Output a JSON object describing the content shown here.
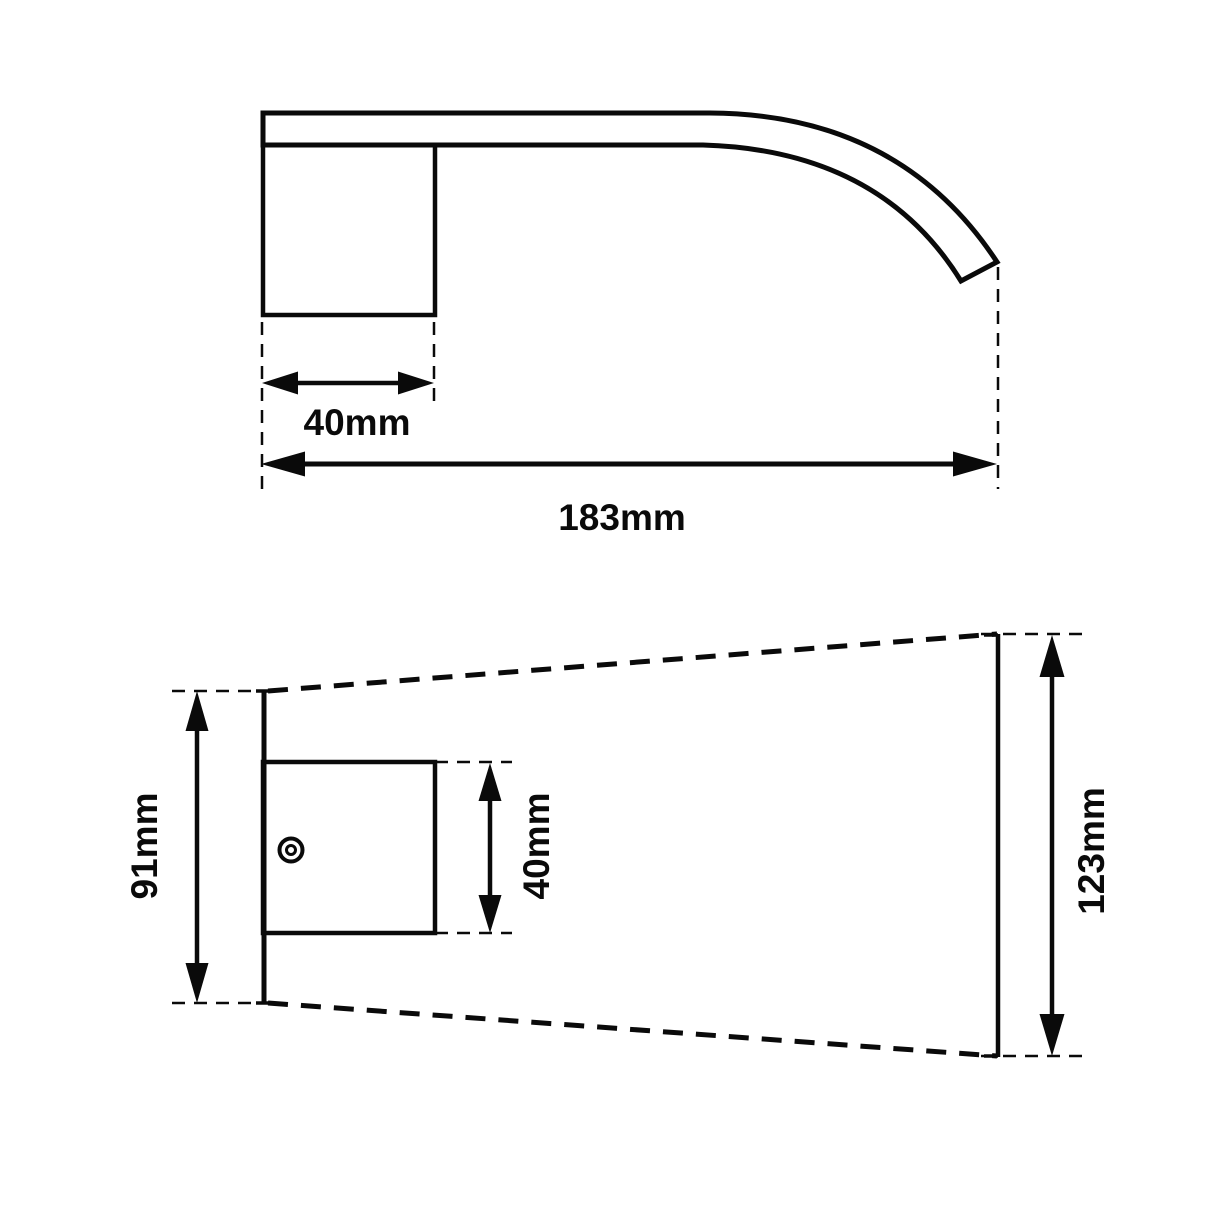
{
  "page": {
    "background_color": "#ffffff",
    "line_color": "#0a0a0a"
  },
  "labels": {
    "side_base_width": "40mm",
    "side_total_length": "183mm",
    "plan_plate_height": "91mm",
    "plan_base_height": "40mm",
    "plan_outlet_end_height": "123mm"
  }
}
